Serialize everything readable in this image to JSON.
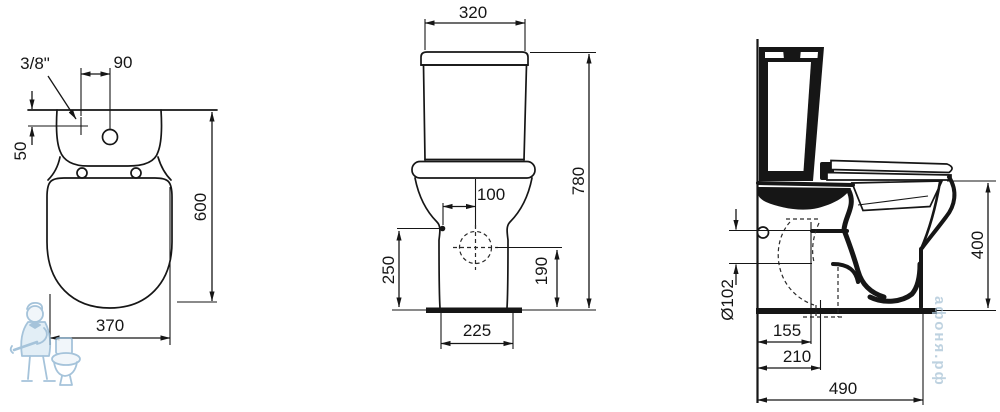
{
  "top_view": {
    "supply_thread": "3/8\"",
    "supply_offset": "90",
    "supply_depth": "50",
    "overall_length": "600",
    "overall_width": "370"
  },
  "front_view": {
    "cistern_width": "320",
    "overall_height": "780",
    "supply_side_offset": "100",
    "supply_height": "250",
    "outlet_axis_height": "190",
    "pedestal_width": "225"
  },
  "side_view": {
    "rim_height": "400",
    "outlet_diameter": "Ø102",
    "outlet_offset_near": "155",
    "outlet_offset_far": "210",
    "overall_depth": "490"
  },
  "watermark": {
    "brand_text": "афоня.рф"
  },
  "colors": {
    "line": "#161616",
    "background": "#ffffff",
    "watermark_blue": "#8fb5d2"
  }
}
